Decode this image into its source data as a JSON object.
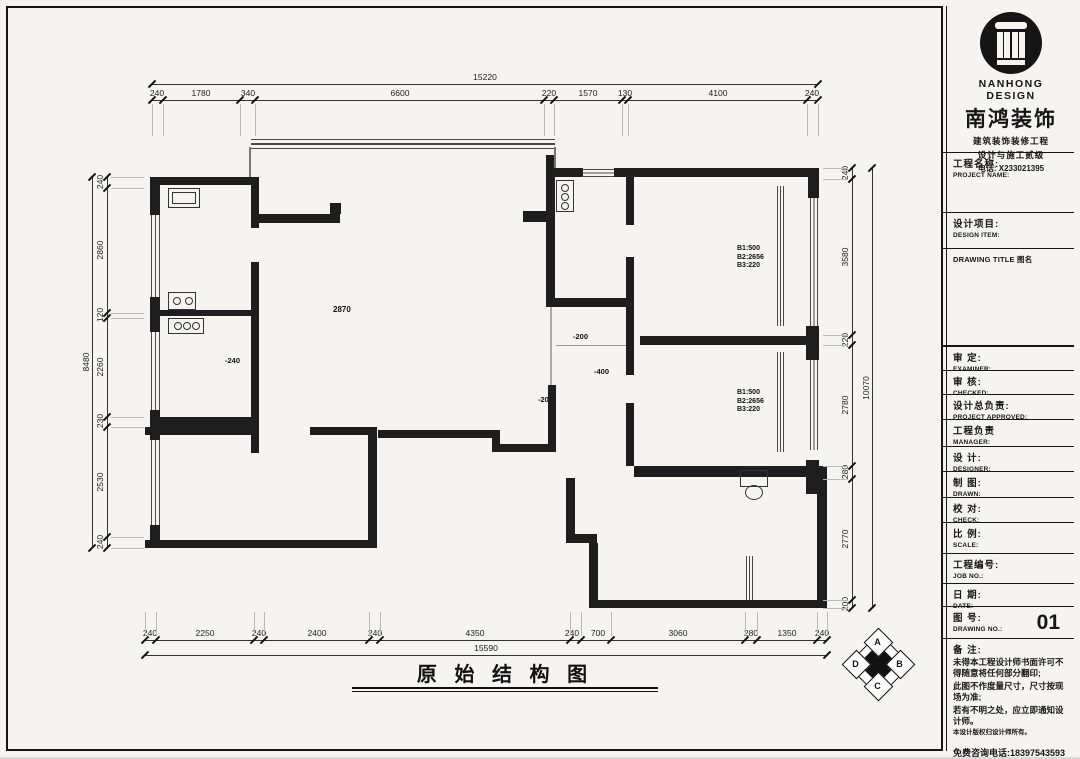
{
  "drawing": {
    "title": "原 始 结 构 图",
    "room_height": "2870",
    "level_marks": {
      "m1": "-240",
      "m2": "-200",
      "m3": "-400",
      "m4": "-200"
    },
    "window_spec": {
      "l1": "B1:500",
      "l2": "B2:2656",
      "l3": "B3:220"
    },
    "compass": {
      "n": "A",
      "e": "B",
      "s": "C",
      "w": "D"
    }
  },
  "dimensions": {
    "top": {
      "total": "15220",
      "segments": [
        "240",
        "1780",
        "340",
        "6600",
        "220",
        "1570",
        "130",
        "4100",
        "240"
      ]
    },
    "bottom": {
      "total": "15590",
      "segments": [
        "240",
        "2250",
        "240",
        "2400",
        "240",
        "4350",
        "240",
        "700",
        "3060",
        "280",
        "1350",
        "240"
      ]
    },
    "left": {
      "total": "8480",
      "segments": [
        "240",
        "2860",
        "120",
        "2260",
        "230",
        "2530",
        "240"
      ]
    },
    "right": {
      "total": "10070",
      "segments": [
        "240",
        "3580",
        "220",
        "2780",
        "280",
        "2770",
        "200"
      ]
    }
  },
  "title_block": {
    "logo": {
      "brand_en": "NANHONG DESIGN",
      "brand_cn": "南鸿装饰",
      "sub1": "建筑装饰装修工程",
      "sub2": "设计与施工贰级",
      "phone": "电话: X233021395"
    },
    "project_name": {
      "cn": "工程名称:",
      "en": "PROJECT NAME:"
    },
    "design_item": {
      "cn": "设计项目:",
      "en": "DESIGN ITEM:"
    },
    "drawing_title_label": "DRAWING TITLE 图名",
    "rows": [
      {
        "cn": "审  定:",
        "en": "EXAMINER:"
      },
      {
        "cn": "审  核:",
        "en": "CHECKED:"
      },
      {
        "cn": "设计总负责:",
        "en": "PROJECT APPROVED:"
      },
      {
        "cn": "工程负责",
        "en": "MANAGER:"
      },
      {
        "cn": "设  计:",
        "en": "DESIGNER:"
      },
      {
        "cn": "制  图:",
        "en": "DRAWN:"
      },
      {
        "cn": "校  对:",
        "en": "CHECK:"
      },
      {
        "cn": "比  例:",
        "en": "SCALE:"
      },
      {
        "cn": "工程编号:",
        "en": "JOB NO.:"
      },
      {
        "cn": "日  期:",
        "en": "DATE:"
      }
    ],
    "drawing_no": {
      "cn": "图  号:",
      "en": "DRAWING NO.:",
      "value": "01"
    },
    "notes": {
      "label": "备  注:",
      "lines": [
        "未得本工程设计师书面许可不得随意将任何部分翻印;",
        "此图不作度量尺寸，尺寸按现场为准;",
        "若有不明之处，应立即通知设计师。",
        "本设计版权归设计师所有。"
      ],
      "hotline": "免费咨询电话:18397543593"
    }
  }
}
